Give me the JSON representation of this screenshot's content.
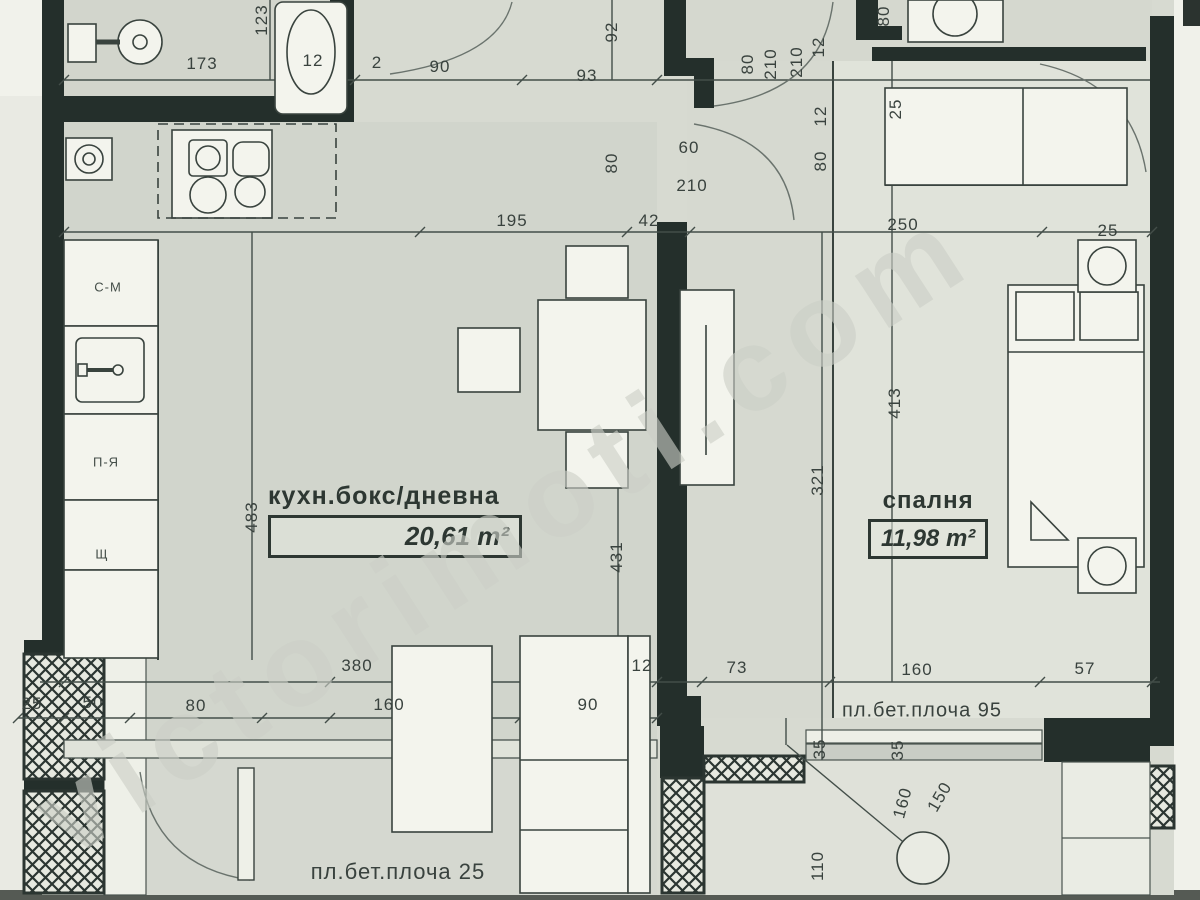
{
  "watermark": "victorimoti.com",
  "rooms": {
    "living": {
      "name": "кухн.бокс/дневна",
      "area": "20,61 m²"
    },
    "bedroom": {
      "name": "спалня",
      "area": "11,98 m²"
    }
  },
  "notes": {
    "right": "пл.бет.плоча 95",
    "bottom": "пл.бет.плоча 25"
  },
  "fixture_labels": [
    {
      "t": "С-М",
      "x": 108,
      "y": 287
    },
    {
      "t": "П-Я",
      "x": 106,
      "y": 462
    },
    {
      "t": "Щ",
      "x": 102,
      "y": 554
    }
  ],
  "dim_labels": [
    {
      "t": "173",
      "x": 202,
      "y": 64,
      "r": 0
    },
    {
      "t": "12",
      "x": 313,
      "y": 61,
      "r": 0
    },
    {
      "t": "2",
      "x": 377,
      "y": 63,
      "r": 0
    },
    {
      "t": "90",
      "x": 440,
      "y": 67,
      "r": 0
    },
    {
      "t": "93",
      "x": 587,
      "y": 76,
      "r": 0
    },
    {
      "t": "92",
      "x": 612,
      "y": 32,
      "r": -90
    },
    {
      "t": "123",
      "x": 262,
      "y": 20,
      "r": -90
    },
    {
      "t": "80",
      "x": 748,
      "y": 64,
      "r": -90
    },
    {
      "t": "210",
      "x": 771,
      "y": 64,
      "r": -90
    },
    {
      "t": "210",
      "x": 797,
      "y": 62,
      "r": -90
    },
    {
      "t": "12",
      "x": 819,
      "y": 47,
      "r": -90
    },
    {
      "t": "12",
      "x": 821,
      "y": 116,
      "r": -90
    },
    {
      "t": "80",
      "x": 821,
      "y": 161,
      "r": -90
    },
    {
      "t": "80",
      "x": 884,
      "y": 16,
      "r": -90
    },
    {
      "t": "80",
      "x": 612,
      "y": 163,
      "r": -90
    },
    {
      "t": "60",
      "x": 689,
      "y": 148,
      "r": 0
    },
    {
      "t": "210",
      "x": 692,
      "y": 186,
      "r": 0
    },
    {
      "t": "195",
      "x": 512,
      "y": 221,
      "r": 0
    },
    {
      "t": "42",
      "x": 649,
      "y": 221,
      "r": 0
    },
    {
      "t": "250",
      "x": 903,
      "y": 225,
      "r": 0
    },
    {
      "t": "25",
      "x": 1108,
      "y": 231,
      "r": 0
    },
    {
      "t": "25",
      "x": 896,
      "y": 109,
      "r": -90
    },
    {
      "t": "483",
      "x": 252,
      "y": 517,
      "r": -90
    },
    {
      "t": "431",
      "x": 617,
      "y": 557,
      "r": -90
    },
    {
      "t": "413",
      "x": 895,
      "y": 403,
      "r": -90
    },
    {
      "t": "321",
      "x": 818,
      "y": 480,
      "r": -90
    },
    {
      "t": "380",
      "x": 357,
      "y": 666,
      "r": 0
    },
    {
      "t": "12",
      "x": 642,
      "y": 666,
      "r": 0
    },
    {
      "t": "73",
      "x": 737,
      "y": 668,
      "r": 0
    },
    {
      "t": "160",
      "x": 917,
      "y": 670,
      "r": 0
    },
    {
      "t": "57",
      "x": 1085,
      "y": 669,
      "r": 0
    },
    {
      "t": "25",
      "x": 32,
      "y": 704,
      "r": 0
    },
    {
      "t": "50",
      "x": 93,
      "y": 703,
      "r": 0
    },
    {
      "t": "80",
      "x": 196,
      "y": 706,
      "r": 0
    },
    {
      "t": "160",
      "x": 389,
      "y": 705,
      "r": 0
    },
    {
      "t": "90",
      "x": 588,
      "y": 705,
      "r": 0
    },
    {
      "t": "35",
      "x": 820,
      "y": 749,
      "r": -90
    },
    {
      "t": "35",
      "x": 898,
      "y": 750,
      "r": -90
    },
    {
      "t": "160",
      "x": 903,
      "y": 803,
      "r": -75
    },
    {
      "t": "150",
      "x": 940,
      "y": 797,
      "r": -60
    },
    {
      "t": "110",
      "x": 818,
      "y": 866,
      "r": -90
    }
  ]
}
